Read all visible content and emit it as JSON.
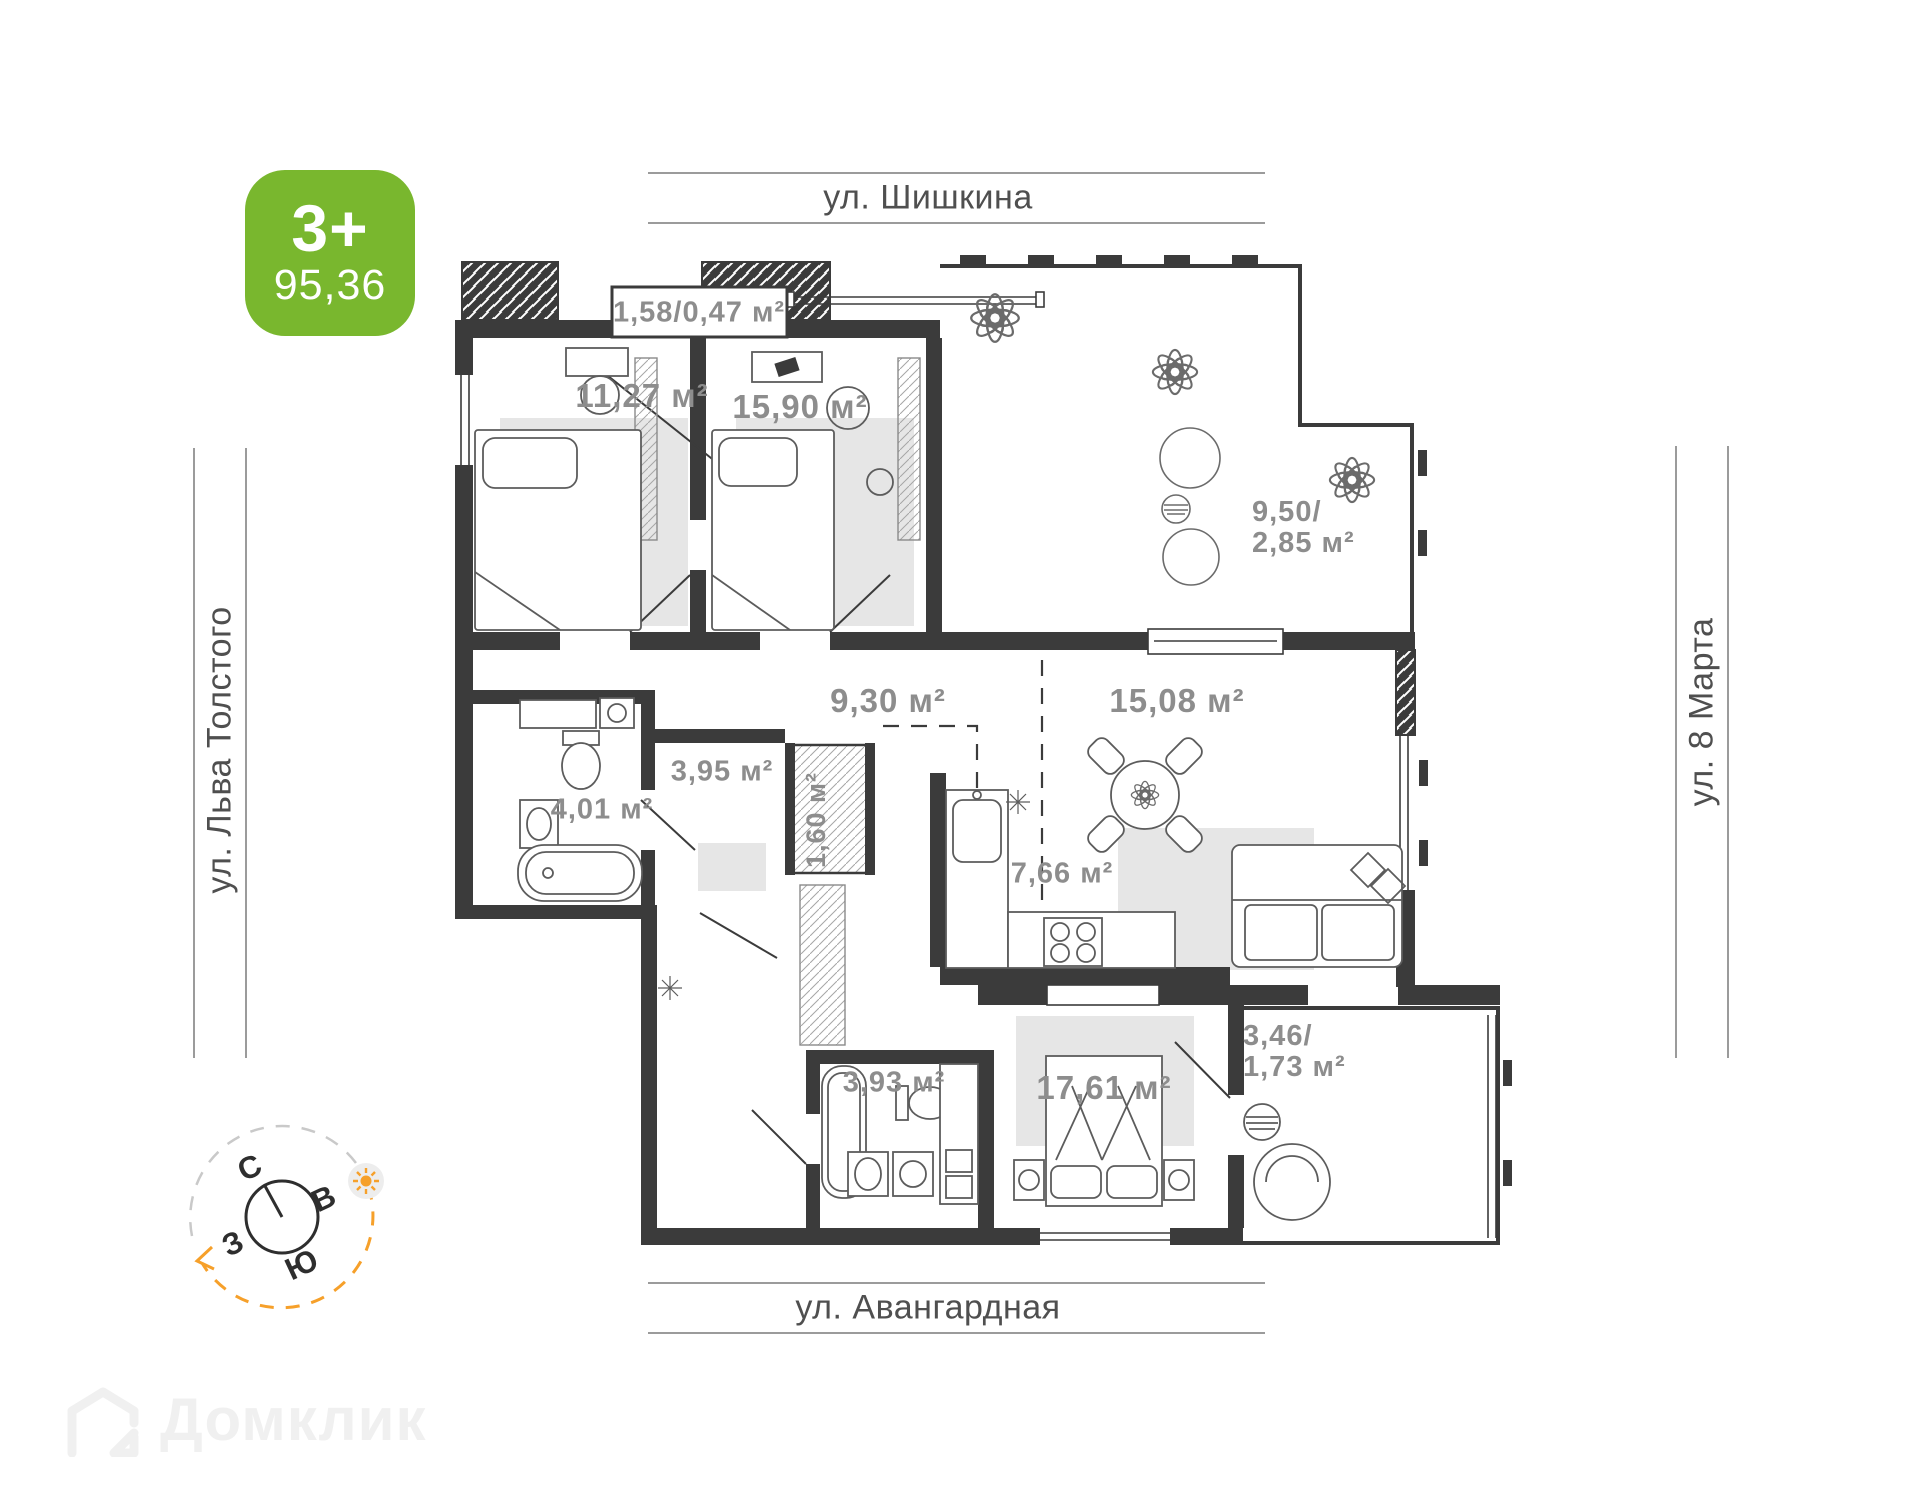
{
  "apartment_badge": {
    "type_label": "3+",
    "area_value": "95,36",
    "color": "#79b72e"
  },
  "streets": {
    "top": "ул. Шишкина",
    "left": "ул. Льва Толстого",
    "right": "ул. 8 Марта",
    "bottom": "ул. Авангардная"
  },
  "floor_plan": {
    "total_area_m2": "95,36",
    "rooms": [
      {
        "name": "balcony-top",
        "area_label": "1,58/0,47 м²"
      },
      {
        "name": "bedroom-1",
        "area_label": "11,27 м²"
      },
      {
        "name": "bedroom-2",
        "area_label": "15,90 м²"
      },
      {
        "name": "terrace",
        "area_label": "9,50/\n2,85 м²"
      },
      {
        "name": "hallway",
        "area_label": "9,30 м²"
      },
      {
        "name": "living-room",
        "area_label": "15,08 м²"
      },
      {
        "name": "hall-2",
        "area_label": "3,95 м²"
      },
      {
        "name": "bathroom-1",
        "area_label": "4,01 м²"
      },
      {
        "name": "wardrobe",
        "area_label": "1,60 м²"
      },
      {
        "name": "kitchen",
        "area_label": "7,66 м²"
      },
      {
        "name": "bathroom-2",
        "area_label": "3,93 м²"
      },
      {
        "name": "bedroom-3",
        "area_label": "17,61 м²"
      },
      {
        "name": "balcony-bottom",
        "area_label": "3,46/\n1,73 м²"
      }
    ]
  },
  "compass": {
    "north": "С",
    "east": "В",
    "south": "Ю",
    "west": "З"
  },
  "watermark": {
    "brand": "Домклик"
  },
  "colors": {
    "badge_green": "#79b72e",
    "wall_dark": "#3b3b3b",
    "room_label_gray": "#8d8d8d",
    "street_gray": "#4f4f4f",
    "compass_orange": "#f6a02a"
  }
}
